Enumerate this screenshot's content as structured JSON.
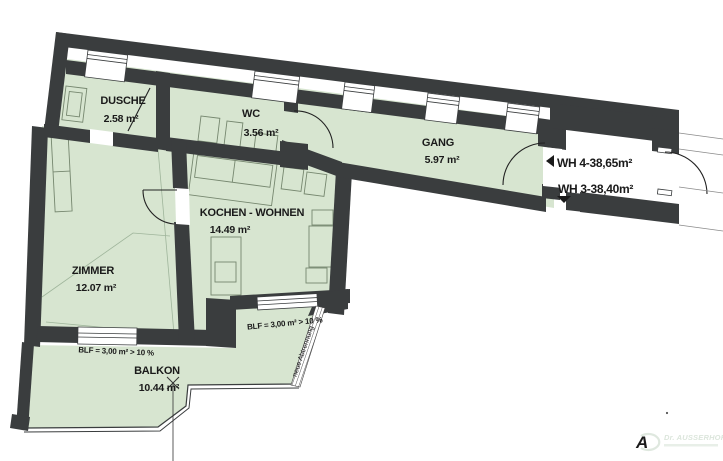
{
  "rooms": [
    {
      "name": "DUSCHE",
      "area": "2.58 m²"
    },
    {
      "name": "WC",
      "area": "3.56 m²"
    },
    {
      "name": "GANG",
      "area": "5.97 m²"
    },
    {
      "name": "KOCHEN - WOHNEN",
      "area": "14.49 m²"
    },
    {
      "name": "ZIMMER",
      "area": "12.07 m²"
    },
    {
      "name": "BALKON",
      "area": "10.44 m²"
    }
  ],
  "units": {
    "wh4": "WH 4-38,65m²",
    "wh3": "WH 3-38,40m²"
  },
  "annotations": {
    "blf_zimmer": "BLF = 3,00 m² > 10 %",
    "blf_kochen": "BLF = 3,00 m² > 10 %",
    "new_partition": "neue Abtrennung"
  },
  "watermark": {
    "brand": "Dr. AUSSERHOFER"
  },
  "colors": {
    "wall": "#3a3d3e",
    "room_fill": "#d7e5d0",
    "furniture_line": "#76876f",
    "text": "#1a1a1a",
    "watermark": "#dce6dc"
  }
}
